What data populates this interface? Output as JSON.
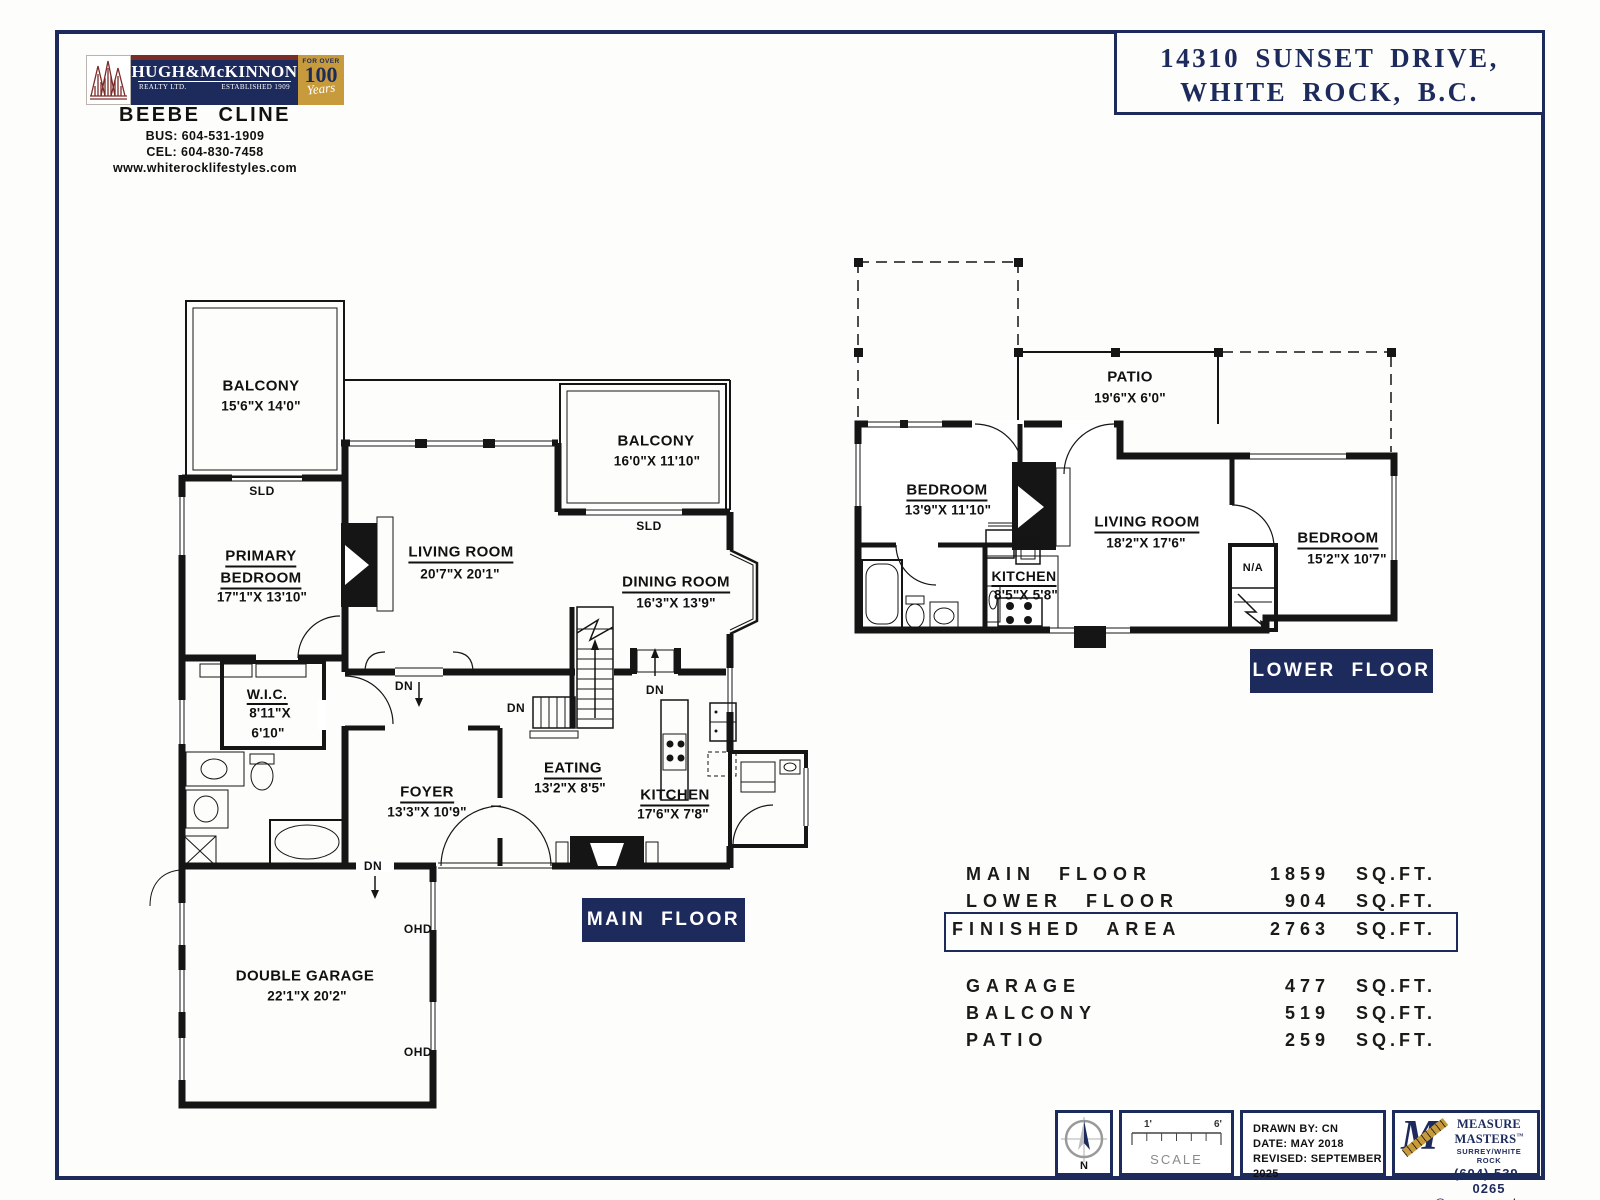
{
  "header": {
    "logo": {
      "brand": "HUGH&McKINNON",
      "realty": "REALTY LTD.",
      "established": "ESTABLISHED 1909",
      "badge_top": "FOR OVER",
      "badge_num": "100",
      "badge_script": "Years"
    },
    "agent": {
      "name": "BEEBE CLINE",
      "bus": "BUS: 604-531-1909",
      "cel": "CEL: 604-830-7458",
      "web": "www.whiterocklifestyles.com"
    },
    "address": {
      "line1": "14310 SUNSET DRIVE,",
      "line2": "WHITE ROCK, B.C."
    }
  },
  "main_floor": {
    "badge": "MAIN FLOOR",
    "rooms": {
      "balcony1": [
        "BALCONY",
        "15'6\"X  14'0\""
      ],
      "balcony2": [
        "BALCONY",
        "16'0\"X  11'10\""
      ],
      "living": [
        "LIVING ROOM",
        "20'7\"X  20'1\""
      ],
      "dining": [
        "DINING ROOM",
        "16'3\"X  13'9\""
      ],
      "primary": [
        "PRIMARY",
        "BEDROOM",
        "17\"1\"X  13'10\""
      ],
      "wic": [
        "W.I.C.",
        "8'11\"X",
        "6'10\""
      ],
      "foyer": [
        "FOYER",
        "13'3\"X  10'9\""
      ],
      "eating": [
        "EATING",
        "13'2\"X  8'5\""
      ],
      "kitchen": [
        "KITCHEN",
        "17'6\"X  7'8\""
      ],
      "garage": [
        "DOUBLE GARAGE",
        "22'1\"X  20'2\""
      ]
    }
  },
  "lower_floor": {
    "badge": "LOWER FLOOR",
    "rooms": {
      "patio": [
        "PATIO",
        "19'6\"X  6'0\""
      ],
      "bedroom1": [
        "BEDROOM",
        "13'9\"X  11'10\""
      ],
      "living": [
        "LIVING ROOM",
        "18'2\"X  17'6\""
      ],
      "kitchen": [
        "KITCHEN",
        "8'5\"X  5'8\""
      ],
      "bedroom2": [
        "BEDROOM",
        "15'2\"X  10'7\""
      ]
    }
  },
  "ann": {
    "sld": "SLD",
    "dn": "DN",
    "ohd": "OHD",
    "na": "N/A"
  },
  "area_table": {
    "rows": [
      {
        "label": "MAIN FLOOR",
        "value": "1859",
        "unit": "SQ.FT."
      },
      {
        "label": "LOWER FLOOR",
        "value": "904",
        "unit": "SQ.FT."
      },
      {
        "label": "FINISHED AREA",
        "value": "2763",
        "unit": "SQ.FT."
      },
      {
        "label": "GARAGE",
        "value": "477",
        "unit": "SQ.FT."
      },
      {
        "label": "BALCONY",
        "value": "519",
        "unit": "SQ.FT."
      },
      {
        "label": "PATIO",
        "value": "259",
        "unit": "SQ.FT."
      }
    ]
  },
  "footer": {
    "north": "N",
    "scale": {
      "left": "1'",
      "right": "6'",
      "label": "SCALE"
    },
    "drawn_by": "DRAWN BY: CN",
    "date": "DATE: MAY 2018",
    "revised": "REVISED: SEPTEMBER 2025",
    "mm": {
      "m": "M",
      "name": "MEASURE MASTERS",
      "tm": "™",
      "region": "SURREY/WHITE ROCK",
      "phone": "(604) 539-0265",
      "email": "surrey@measuremasters.ca"
    }
  }
}
